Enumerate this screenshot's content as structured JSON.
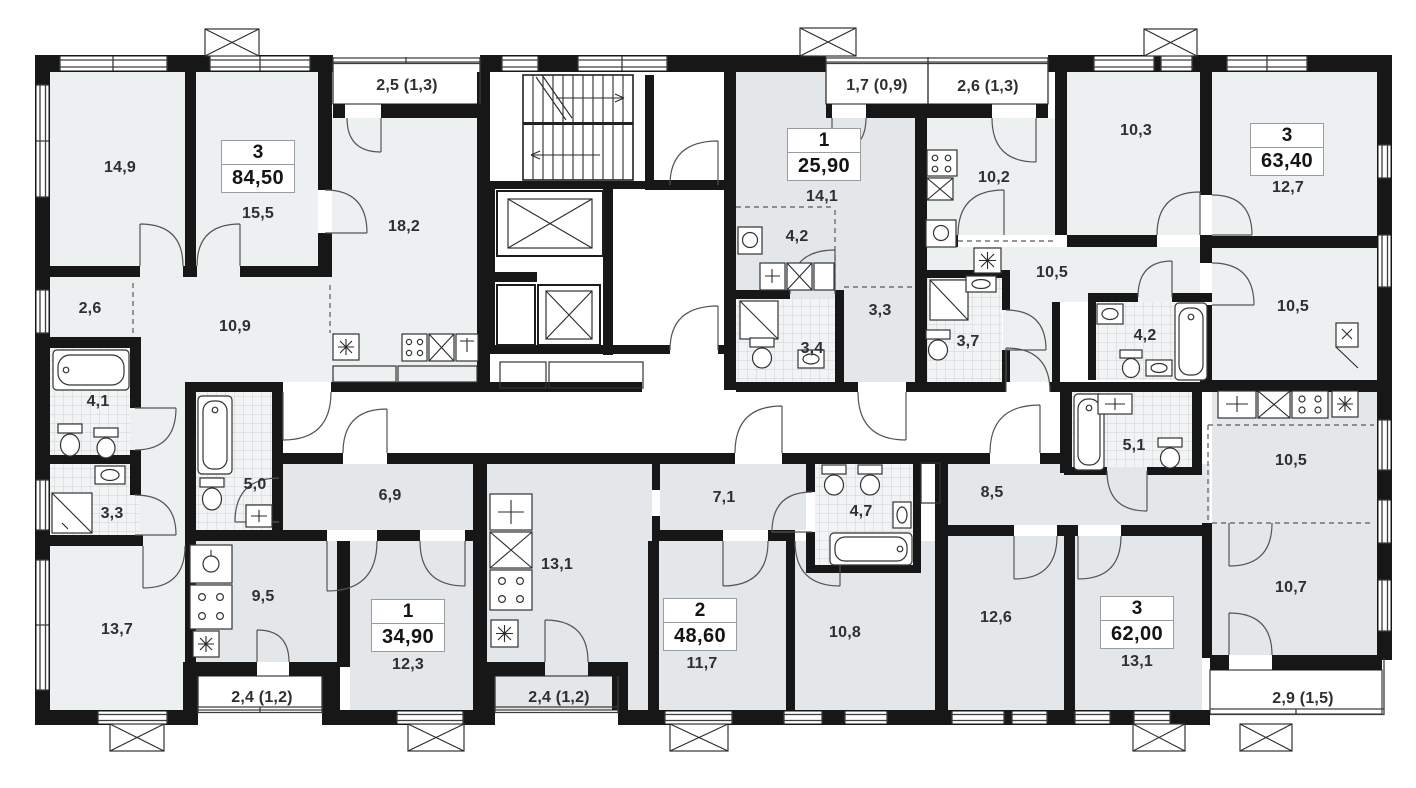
{
  "apartments": [
    {
      "type": "3",
      "area": "84,50",
      "balcony": "2,5 (1,3)",
      "rooms": [
        "14,9",
        "15,5",
        "18,2",
        "10,9",
        "2,6",
        "4,1",
        "3,3",
        "13,7"
      ]
    },
    {
      "type": "1",
      "area": "34,90",
      "balcony": "2,4 (1,2)",
      "rooms": [
        "5,0",
        "6,9",
        "9,5",
        "12,3"
      ]
    },
    {
      "type": "2",
      "area": "48,60",
      "balcony": "2,4 (1,2)",
      "rooms": [
        "13,1",
        "7,1",
        "4,7",
        "11,7",
        "10,8"
      ]
    },
    {
      "type": "1",
      "area": "25,90",
      "balcony": "1,7 (0,9)",
      "rooms": [
        "14,1",
        "4,2",
        "3,4",
        "3,3"
      ]
    },
    {
      "type": "3",
      "area": "63,40",
      "balcony": "2,6 (1,3)",
      "rooms": [
        "10,2",
        "10,3",
        "12,7",
        "10,5",
        "3,7",
        "4,2",
        "10,5"
      ]
    },
    {
      "type": "3",
      "area": "62,00",
      "balcony": "2,9 (1,5)",
      "rooms": [
        "8,5",
        "5,1",
        "10,5",
        "12,6",
        "13,1",
        "10,7"
      ]
    }
  ]
}
